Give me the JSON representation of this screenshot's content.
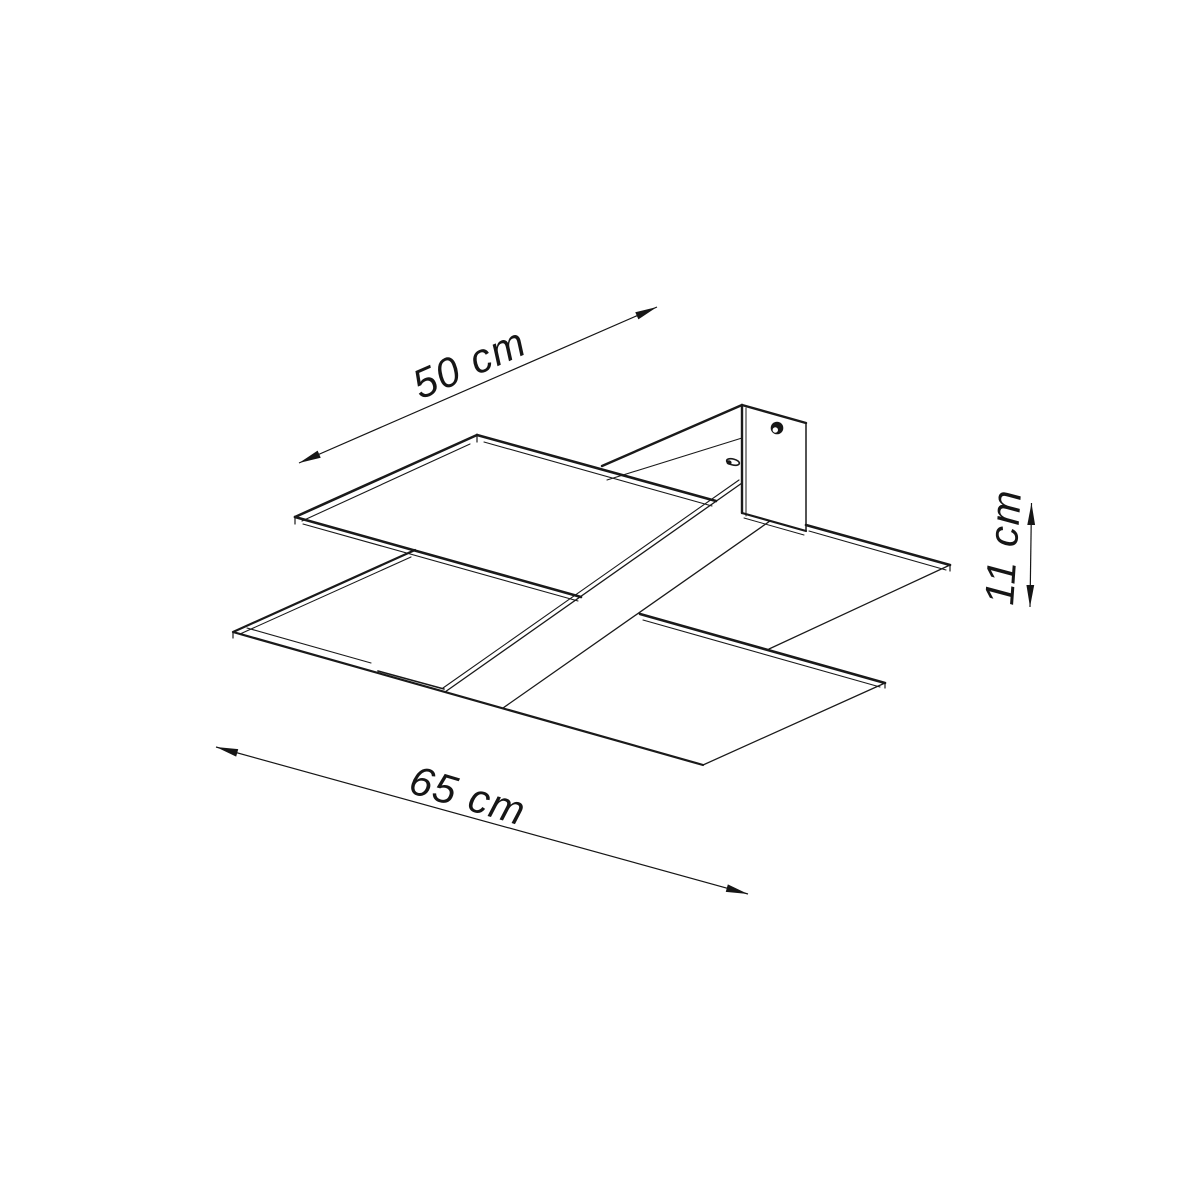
{
  "drawing": {
    "kind": "ceiling-lamp dimension drawing",
    "background_color": "#ffffff",
    "line_color": "#1a1a1a"
  },
  "dimensions": {
    "depth": {
      "label": "50 cm",
      "value": 50,
      "unit": "cm"
    },
    "width": {
      "label": "65 cm",
      "value": 65,
      "unit": "cm"
    },
    "height": {
      "label": "11 cm",
      "value": 11,
      "unit": "cm"
    }
  }
}
